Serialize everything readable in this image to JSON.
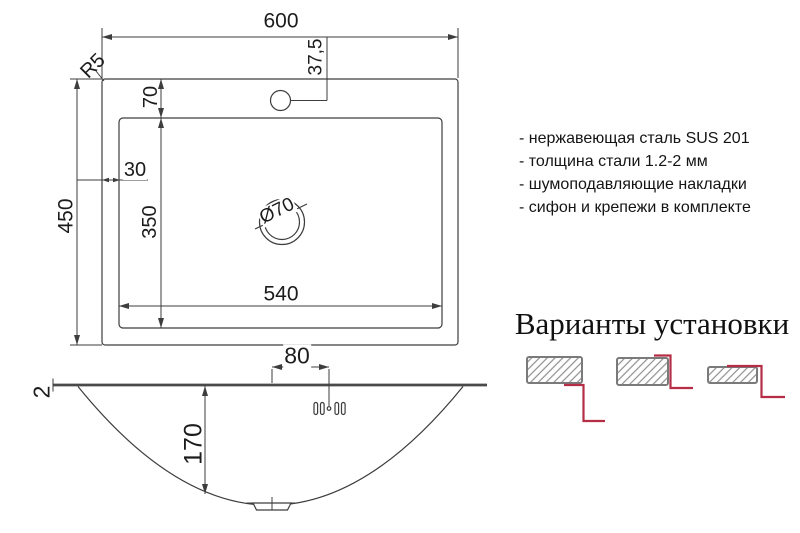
{
  "top_view": {
    "width": "600",
    "height": "450",
    "corner_radius": "R5",
    "hole_offset": "37,5",
    "bowl_top_offset": "70",
    "bowl_left_offset": "30",
    "bowl_height": "350",
    "bowl_width": "540",
    "drain_diameter": "Ø70"
  },
  "side_view": {
    "steel_thickness": "2",
    "hole_spacing": "80",
    "bowl_depth": "170"
  },
  "specs": {
    "items": [
      "- нержавеющая сталь SUS 201",
      "- толщина стали 1.2-2 мм",
      "- шумоподавляющие накладки",
      "- сифон и крепежи в комплекте"
    ]
  },
  "installation": {
    "title": "Варианты установки",
    "variant_icons": [
      "undermount-diagram",
      "flush-mount-diagram",
      "top-mount-diagram"
    ]
  },
  "colors": {
    "line": "#3d3d3d",
    "accent_red": "#b52e46",
    "hatch_gray": "#8f8f8f"
  }
}
